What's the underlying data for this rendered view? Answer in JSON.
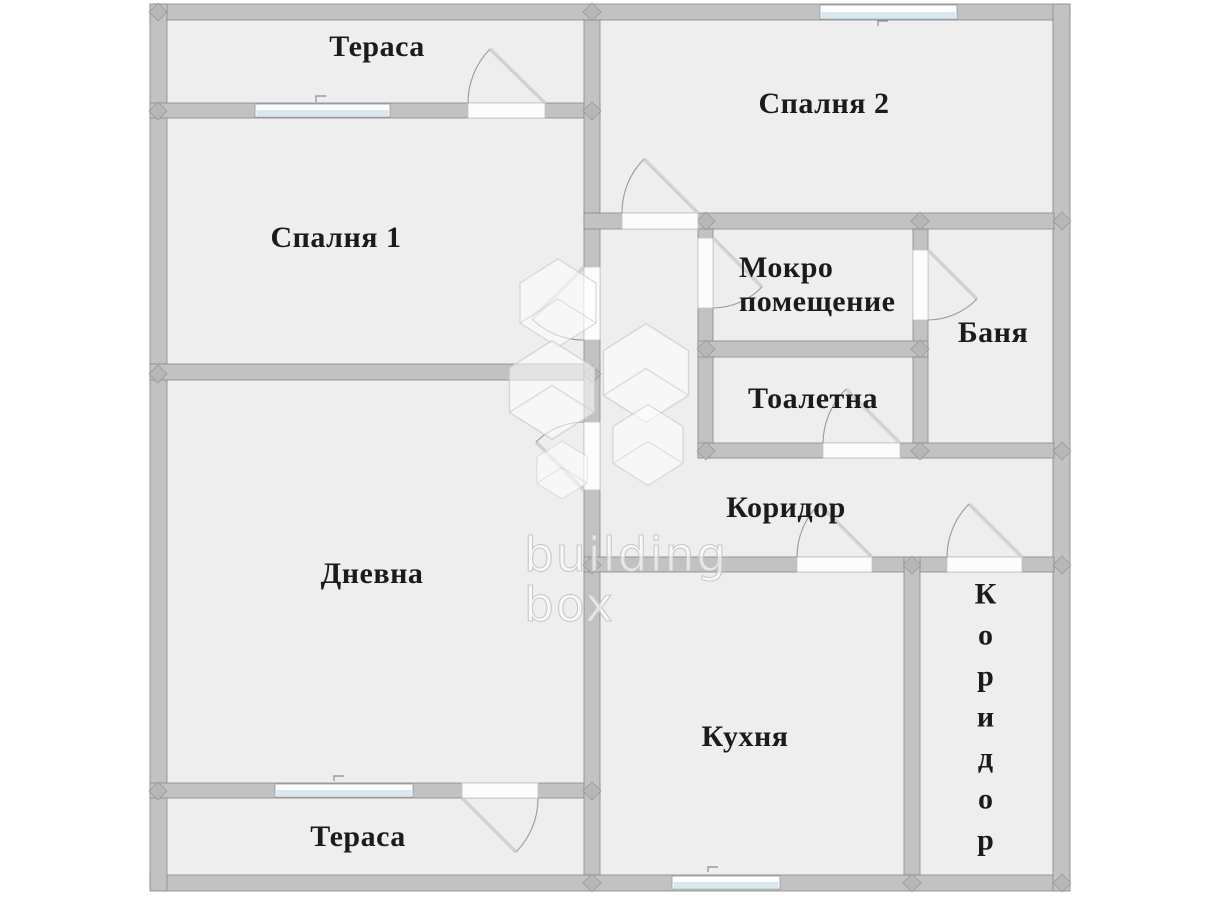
{
  "plan_title": "Apartment floor plan",
  "rooms": {
    "terrace_top": {
      "label": "Тераса"
    },
    "bedroom_2": {
      "label": "Спалня 2"
    },
    "bedroom_1": {
      "label": "Спалня 1"
    },
    "wet_room": {
      "label": "Мокро помещение"
    },
    "bathroom": {
      "label": "Баня"
    },
    "toilet": {
      "label": "Тоалетна"
    },
    "corridor": {
      "label": "Коридор"
    },
    "living_room": {
      "label": "Дневна"
    },
    "kitchen": {
      "label": "Кухня"
    },
    "corridor_side": {
      "label": "Коридор"
    },
    "terrace_bottom": {
      "label": "Тераса"
    }
  },
  "watermark": {
    "line1": "building",
    "line2": "box"
  },
  "counts": {
    "windows": 4,
    "doors": 10
  },
  "colors": {
    "wall": "#c2c2c3",
    "wall-dark": "#b7b7b8",
    "floor": "#eeeeef",
    "window": "#d9e7ef",
    "door": "#9a9a9a",
    "label": "#1b1b1b"
  }
}
